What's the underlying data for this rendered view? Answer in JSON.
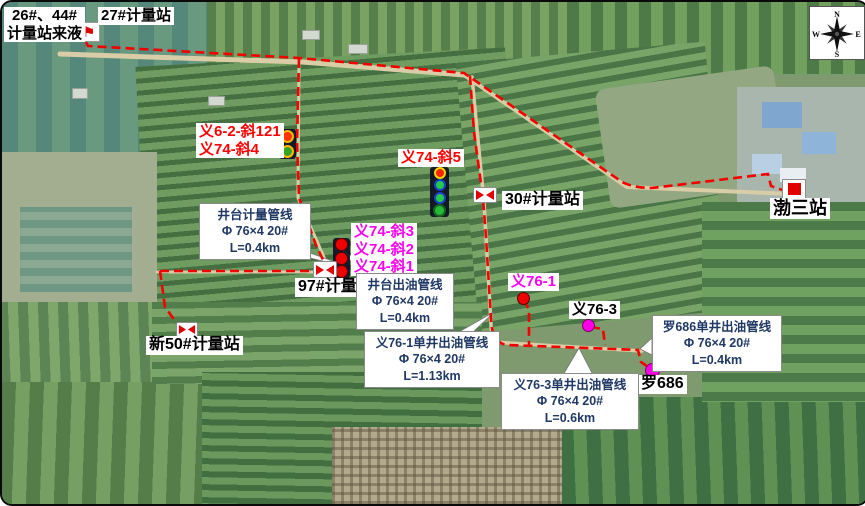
{
  "header": {
    "feed_label_line1": "26#、44#",
    "feed_label_line2": "计量站来液",
    "station27_label": "27#计量站"
  },
  "compass": {
    "n": "N",
    "e": "E",
    "s": "S",
    "w": "W"
  },
  "stations": {
    "s30": "30#计量站",
    "s97": "97#计量站",
    "s50": "新50#计量站",
    "bosan": "渤三站"
  },
  "wells": {
    "y62_121": "义6-2-斜121",
    "y74_4": "义74-斜4",
    "y74_5": "义74-斜5",
    "y74_3": "义74-斜3",
    "y74_2": "义74-斜2",
    "y74_1": "义74-斜1",
    "y76_1": "义76-1",
    "y76_3": "义76-3",
    "luo686": "罗686"
  },
  "callouts": {
    "pad_metering": {
      "line1": "井台计量管线",
      "line2": "Φ 76×4 20#",
      "line3": "L=0.4km"
    },
    "pad_outflow": {
      "line1": "井台出油管线",
      "line2": "Φ 76×4 20#",
      "line3": "L=0.4km"
    },
    "y76_1_line": {
      "line1": "义76-1单井出油管线",
      "line2": "Φ 76×4 20#",
      "line3": "L=1.13km"
    },
    "y76_3_line": {
      "line1": "义76-3单井出油管线",
      "line2": "Φ 76×4 20#",
      "line3": "L=0.6km"
    },
    "luo686_line": {
      "line1": "罗686单井出油管线",
      "line2": "Φ 76×4 20#",
      "line3": "L=0.4km"
    }
  },
  "colors": {
    "pipeline": "#F40000",
    "red_well_label": "#FF0000",
    "pink_well_label": "#FF00EE",
    "callout_text": "#1F3864"
  }
}
